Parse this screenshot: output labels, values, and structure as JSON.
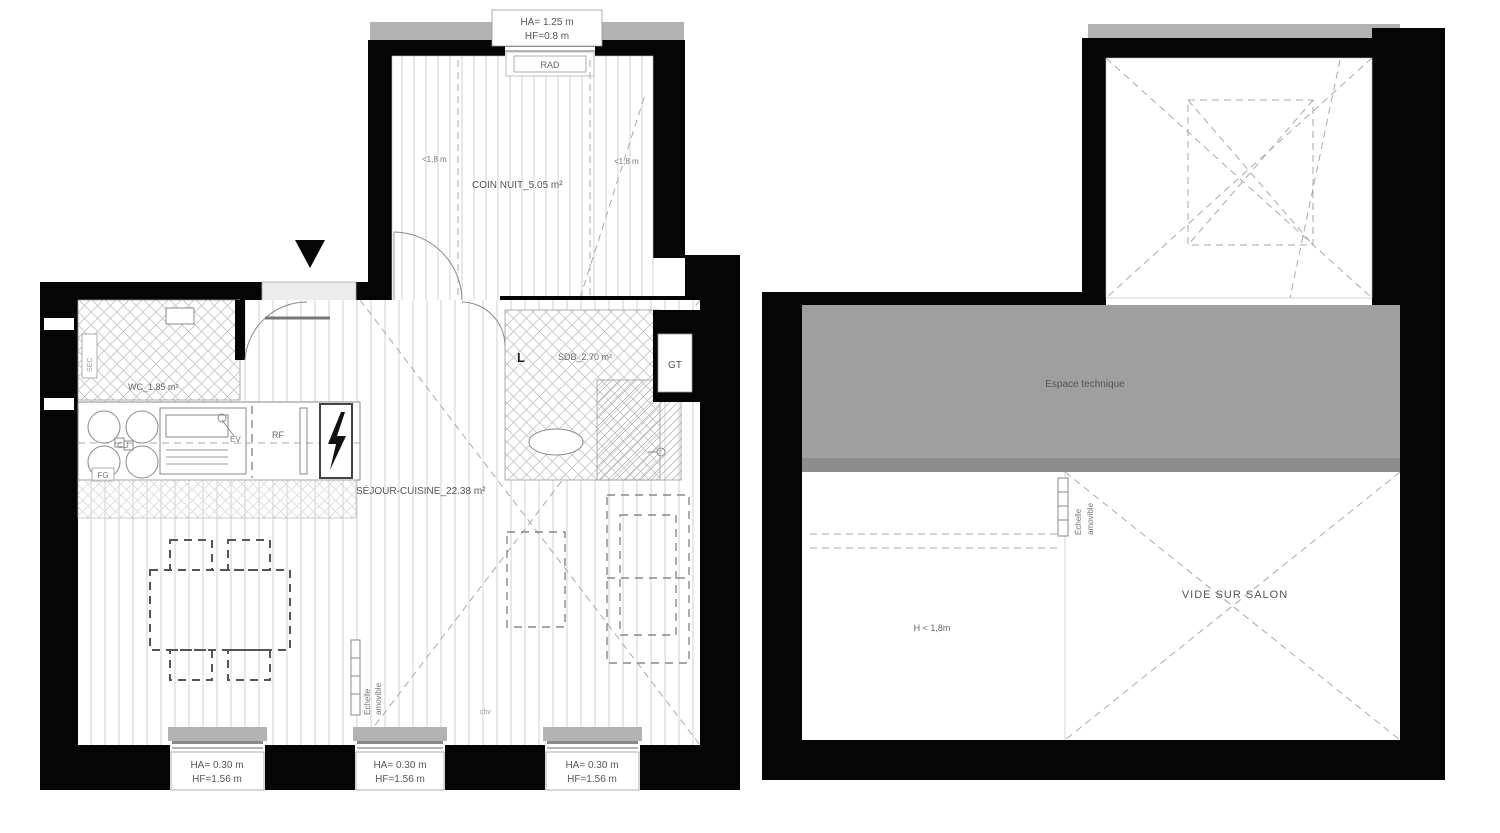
{
  "left_plan": {
    "window_top": {
      "ha": "HA= 1.25 m",
      "hf": "HF=0.8 m"
    },
    "rad_label": "RAD",
    "slope_left": "<1,8 m",
    "slope_right": "<1,8 m",
    "coin_nuit_label": "COIN NUIT_5.05 m²",
    "sec_label": "SEC",
    "wc_label": "WC_1.85 m²",
    "cu_label": "CU",
    "fg_label": "FG",
    "ev_label": "EV",
    "rf_label": "RF",
    "ll_label": "L",
    "sdb_label": "SDB_2.70 m²",
    "gt_label": "GT",
    "sejour_label": "SÉJOUR-CUISINE_22.38 m²",
    "ladder_word1": "Échelle",
    "ladder_word2": "amovible",
    "chv_label": "chv",
    "windows_bottom": [
      {
        "ha": "HA= 0.30 m",
        "hf": "HF=1.56 m"
      },
      {
        "ha": "HA= 0.30 m",
        "hf": "HF=1.56 m"
      },
      {
        "ha": "HA= 0.30 m",
        "hf": "HF=1.56 m"
      }
    ]
  },
  "right_plan": {
    "espace_label": "Espace technique",
    "ladder_word1": "Échelle",
    "ladder_word2": "amovible",
    "height_label": "H < 1,8m",
    "vide_label": "VIDE SUR SALON"
  },
  "colors": {
    "wall": "#050505",
    "sill_gray": "#b3b3b3",
    "espace_gray": "#9f9f9f",
    "hatch": "#cccccc"
  }
}
